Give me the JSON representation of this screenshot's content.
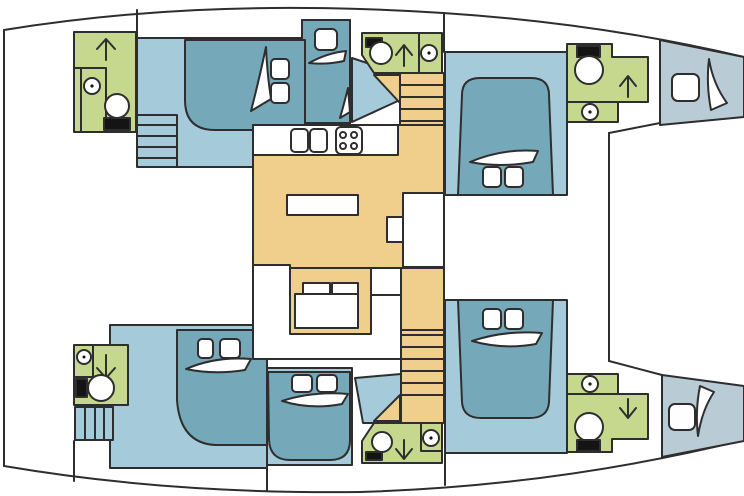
{
  "document": {
    "title": "Catamaran interior deck plan",
    "type": "floor-plan",
    "view": "top-down",
    "bow_direction": "right"
  },
  "colors": {
    "outline": "#2e2e2e",
    "white": "#ffffff",
    "dark": "#141414",
    "cabin_floor": "#a5cad9",
    "berth": "#75a9b9",
    "bathroom": "#c6d88d",
    "salon": "#f0cf8d",
    "bow_locker": "#b9ccd5",
    "background": "#ffffff"
  },
  "plan": {
    "port_hull": [
      "aft head with shower, sink and toilet",
      "aft double cabin with berth",
      "dressing nook with hatch",
      "mid head with shower, sink and toilet",
      "companionway stairs",
      "forward double cabin with berth",
      "forward head with shower, sink and toilet",
      "bow locker with hatch"
    ],
    "bridgedeck_salon": [
      "galley counter with twin sinks",
      "four-burner stove",
      "island counter",
      "chart desk with stool",
      "U-shaped settee with table and two cushions",
      "port companionway stairs",
      "starboard companionway stairs"
    ],
    "starboard_hull": [
      "aft head with shower, sink and toilet",
      "aft steps",
      "two aft double cabins with berths",
      "companionway stairs",
      "mid head with shower, sink and toilet",
      "forward double cabin with berth",
      "forward head with shower, sink and toilet",
      "bow locker with hatch"
    ],
    "foredeck": [
      "trampoline between bows"
    ]
  },
  "icon_legend": {
    "shower_arrow": "direction arrow",
    "sink": "circle with dot",
    "toilet": "bowl circle with dark tank",
    "berth_pillows": "white rounded squares",
    "door_swing": "curved wedge",
    "stairs": "tread lines",
    "stove": "four burner rings",
    "hatch": "rounded square"
  }
}
